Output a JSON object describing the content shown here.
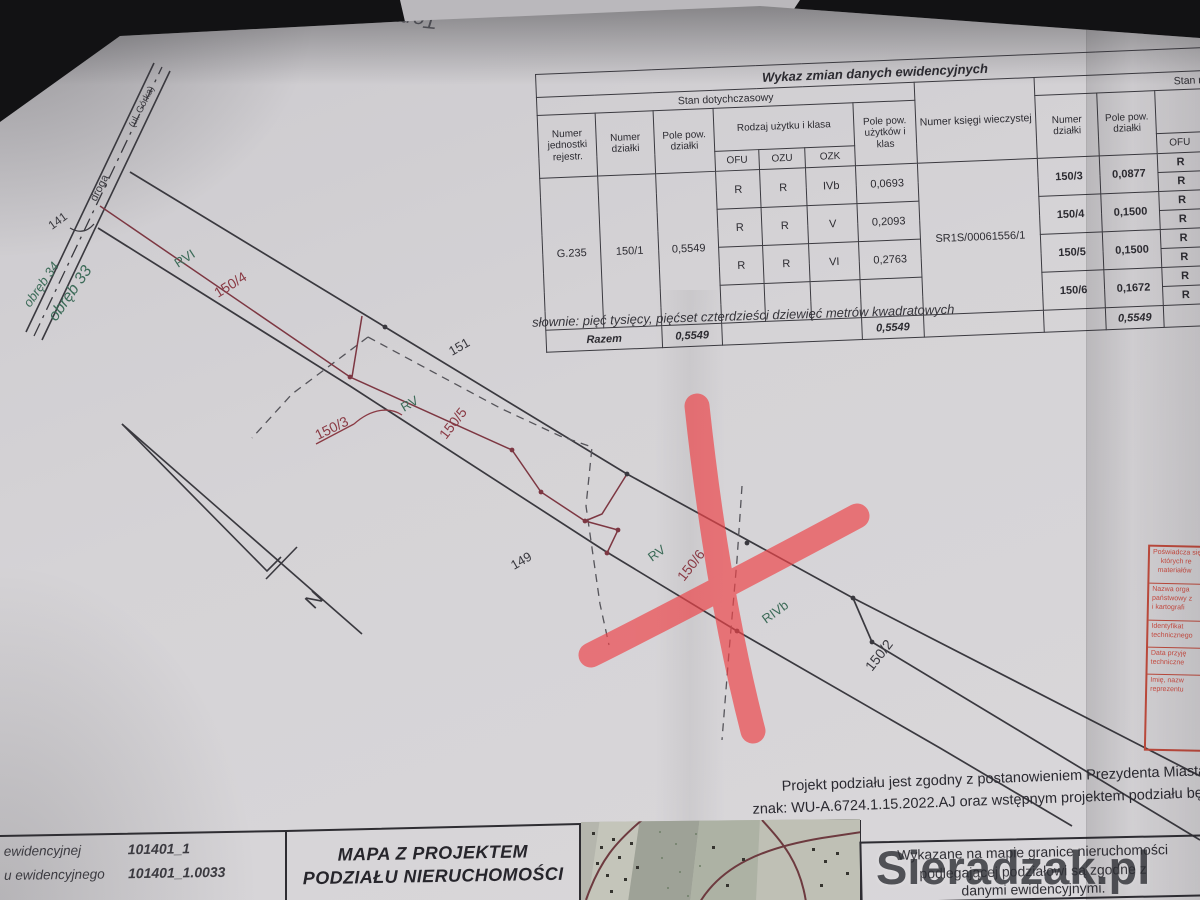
{
  "annotations": {
    "note": "Tomasz  -"
  },
  "change_table": {
    "title": "Wykaz zmian danych ewidencyjnych",
    "old_state_label": "Stan dotychczasowy",
    "new_state_label": "Stan nowy",
    "col_unit": "Numer jednostki rejestr.",
    "col_parcel": "Numer działki",
    "col_area": "Pole pow. działki",
    "col_use_class": "Rodzaj użytku i klasa",
    "col_ofu": "OFU",
    "col_ozu": "OZU",
    "col_ozk": "OZK",
    "col_use_area": "Pole pow. użytków i klas",
    "col_kw": "Numer księgi wieczystej",
    "old": {
      "unit": "G.235",
      "parcel": "150/1",
      "area": "0,5549",
      "classes": [
        {
          "ofu": "R",
          "ozu": "R",
          "ozk": "IVb",
          "area": "0,0693"
        },
        {
          "ofu": "R",
          "ozu": "R",
          "ozk": "V",
          "area": "0,2093"
        },
        {
          "ofu": "R",
          "ozu": "R",
          "ozk": "VI",
          "area": "0,2763"
        },
        {
          "ofu": "",
          "ozu": "",
          "ozk": "",
          "area": ""
        }
      ],
      "kw": "SR1S/00061556/1"
    },
    "new": {
      "parcels": [
        {
          "nr": "150/3",
          "area": "0,0877",
          "ofu": [
            "R",
            "R"
          ]
        },
        {
          "nr": "150/4",
          "area": "0,1500",
          "ofu": [
            "R",
            "R"
          ]
        },
        {
          "nr": "150/5",
          "area": "0,1500",
          "ofu": [
            "R",
            "R"
          ]
        },
        {
          "nr": "150/6",
          "area": "0,1672",
          "ofu": [
            "R",
            "R"
          ]
        }
      ],
      "total_area": "0,5549"
    },
    "razem_label": "Razem",
    "razem_area": "0,5549",
    "razem_use_area": "0,5549",
    "in_words": "słownie: pięć tysięcy, pięćset czterdzieści dziewięć metrów kwadratowych"
  },
  "map": {
    "labels": {
      "rvi": "RVI",
      "p1504": "150/4",
      "p151": "151",
      "rv1": "RV",
      "p1503": "150/3",
      "p1505": "150/5",
      "p149": "149",
      "rv2": "RV",
      "p1506": "150/6",
      "rivb": "RIVb",
      "p1502": "150/2",
      "p141": "141",
      "road": "droga",
      "road_street": "(ul. Górka)",
      "obreb34": "obręb 34",
      "obreb33": "obręb 33",
      "north": "N"
    }
  },
  "footer": {
    "id_line1_label": "ewidencyjnej",
    "id_line1_value": "101401_1",
    "id_line2_label": "u ewidencyjnego",
    "id_line2_value": "101401_1.0033",
    "map_title_line1": "MAPA Z PROJEKTEM",
    "map_title_line2": "PODZIAŁU NIERUCHOMOŚCI",
    "boundary_note_line1": "Wykazane na mapie granice nieruchomości",
    "boundary_note_line2": "podlegającej podziałowi są zgodne z",
    "boundary_note_line3": "danymi ewidencyjnymi.",
    "approval_line1": "Projekt podziału jest zgodny z postanowieniem Prezydenta Miasta Sieradza",
    "approval_line2": "znak: WU-A.6724.1.15.2022.AJ oraz wstępnym projektem podziału będącym",
    "watermark": "Sieradzak.pl"
  },
  "stamp": {
    "rows": [
      [
        "Poświadcza się",
        "których re",
        "materiałów"
      ],
      [
        "Nazwa orga",
        "państwowy z",
        "i kartografi"
      ],
      [
        "Identyfikat",
        "technicznego"
      ],
      [
        "Data przyję",
        "techniczne"
      ],
      [
        "Imię, nazw",
        "reprezentu"
      ]
    ]
  },
  "colors": {
    "paper": "#d5d3d6",
    "ink": "#3b3a40",
    "division_red": "#7d3742",
    "class_green": "#3c6b58",
    "marker_red": "#ee4449",
    "stamp_red": "#c24a3c"
  }
}
